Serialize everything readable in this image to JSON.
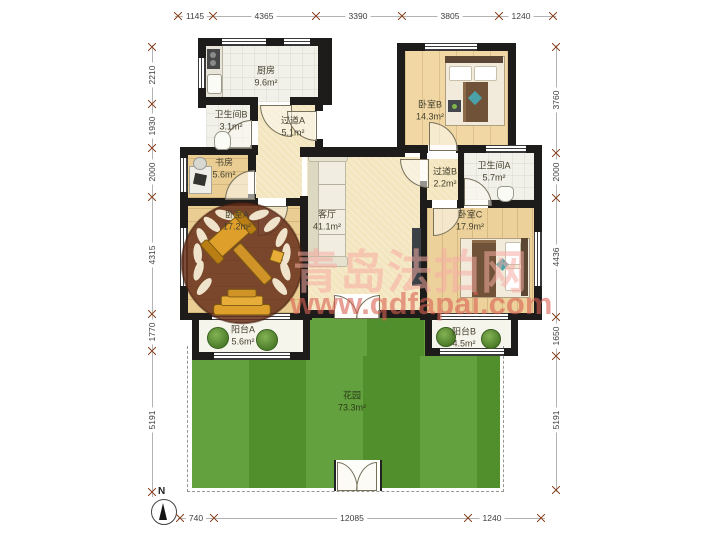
{
  "plan": {
    "compass_label": "N",
    "rooms": [
      {
        "id": "kitchen",
        "name": "厨房",
        "area": "9.6m²"
      },
      {
        "id": "bathroom-b",
        "name": "卫生间B",
        "area": "3.1m²"
      },
      {
        "id": "hallway-a",
        "name": "过道A",
        "area": "5.1m²"
      },
      {
        "id": "study",
        "name": "书房",
        "area": "5.6m²"
      },
      {
        "id": "bedroom-a",
        "name": "卧室A",
        "area": "17.2m²"
      },
      {
        "id": "living-room",
        "name": "客厅",
        "area": "41.1m²"
      },
      {
        "id": "bedroom-b",
        "name": "卧室B",
        "area": "14.3m²"
      },
      {
        "id": "hallway-b",
        "name": "过道B",
        "area": "2.2m²"
      },
      {
        "id": "bathroom-a",
        "name": "卫生间A",
        "area": "5.7m²"
      },
      {
        "id": "bedroom-c",
        "name": "卧室C",
        "area": "17.9m²"
      },
      {
        "id": "balcony-a",
        "name": "阳台A",
        "area": "5.6m²"
      },
      {
        "id": "balcony-b",
        "name": "阳台B",
        "area": "4.5m²"
      },
      {
        "id": "garden",
        "name": "花园",
        "area": "73.3m²"
      }
    ],
    "dimensions": {
      "top": [
        "1145",
        "4365",
        "3390",
        "3805",
        "1240"
      ],
      "bottom": [
        "740",
        "12085",
        "1240"
      ],
      "left": [
        "2210",
        "1930",
        "2000",
        "4315",
        "1770",
        "5191"
      ],
      "right": [
        "3760",
        "2000",
        "4436",
        "1650",
        "5191"
      ]
    }
  },
  "watermark": {
    "title": "青岛法拍网",
    "url": "www.qdfapai.com"
  },
  "colors": {
    "wall": "#1d1c1a",
    "wood_floor": "#e9cd92",
    "cream_floor": "#f3e5bd",
    "tile_floor": "#f1f0e9",
    "grass": "#569a2e",
    "badge_brown": "#662f1a",
    "gavel_gold": "#df9f2b",
    "watermark_text": "#db6054",
    "dimension_tick": "#8a4a2a"
  }
}
